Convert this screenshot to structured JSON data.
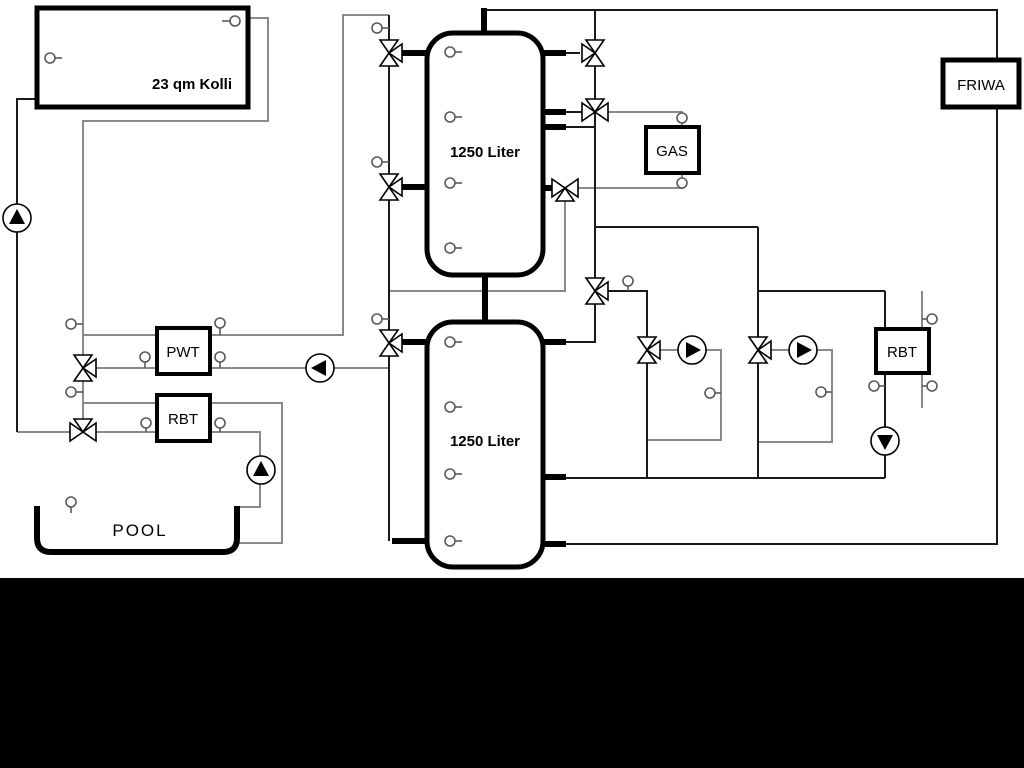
{
  "diagram": {
    "title": "heating-system-schematic",
    "labels": {
      "collector": "23 qm Kolli",
      "tank1": "1250 Liter",
      "tank2": "1250 Liter",
      "gas": "GAS",
      "friwa": "FRIWA",
      "pwt": "PWT",
      "rbt_left": "RBT",
      "rbt_right": "RBT",
      "pool": "POOL"
    },
    "colors": {
      "background": "#ffffff",
      "outline": "#000000",
      "pipe_dark": "#1a1a1a",
      "pipe_gray": "#8a8a8a",
      "bottom_band": "#000000"
    },
    "components": {
      "pumps": [
        "solar-pump",
        "pwt-pump",
        "pool-pump",
        "circuit1-pump",
        "circuit2-pump",
        "rbt-return-pump"
      ],
      "valve_count": 11,
      "sensor_count": 25
    }
  }
}
